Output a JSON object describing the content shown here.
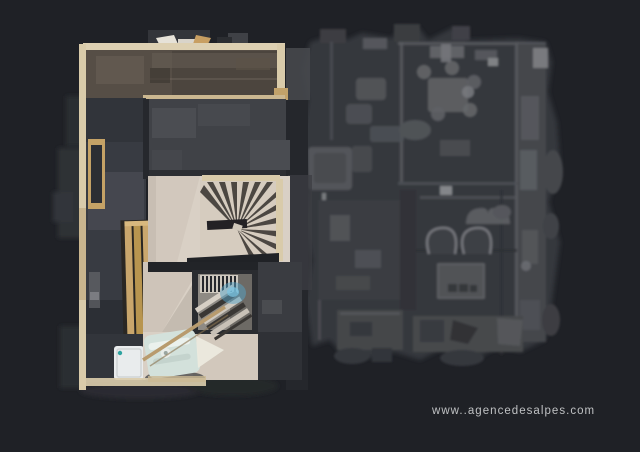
{
  "watermark": {
    "text": "www..agencedesalpes.com"
  },
  "colors": {
    "bg": "#1f2126",
    "ghost_base": "#36383d",
    "ghost_room": "#404247",
    "ghost_wall": "#5a5c61",
    "ghost_light": "#6e7075",
    "slate": "#383b42",
    "slate_dark": "#2c2f35",
    "wood_wall": "#d9cbaa",
    "wood_tan": "#c5a266",
    "brown_floor": "#564e46",
    "pale_floor": "#d9d0c5",
    "tread_dark": "#3a3531",
    "white_fixture": "#e9eced",
    "teal_bed": "#d3e1db",
    "blue_glow": "#55a4c8",
    "text": "#bfc1c3"
  },
  "scene": {
    "description": "top-down dollhouse scan of a chalet floor",
    "regions": [
      "lounge-kitchen-l-room",
      "left-wing-hallway",
      "wall-cabinet",
      "wooden-bench",
      "shower-room",
      "spiral-staircase",
      "stairwell-opening",
      "daybed",
      "ghost-adjacent-rooms"
    ]
  }
}
